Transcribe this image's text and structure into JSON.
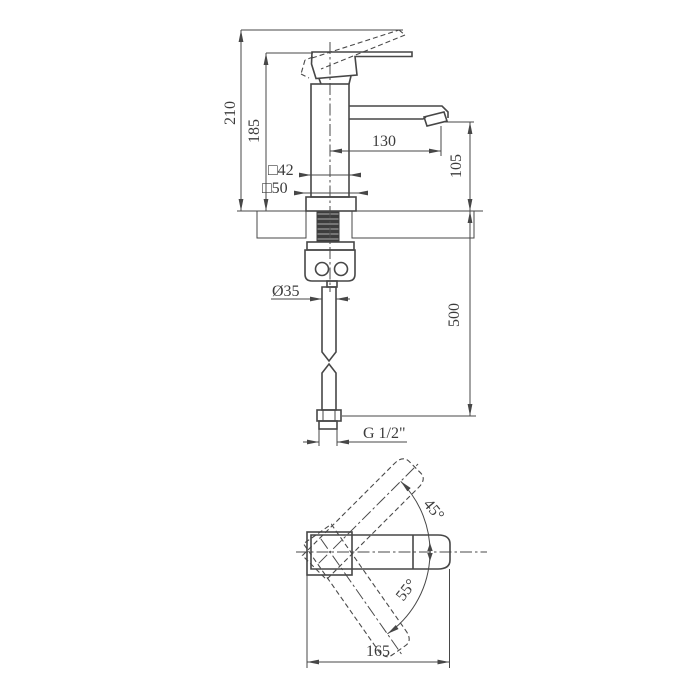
{
  "front_view": {
    "labels": {
      "height_total": "210",
      "height_lever": "185",
      "spout_reach": "130",
      "spout_height": "105",
      "body_section": "□42",
      "base_section": "□50",
      "shank_diameter": "Ø35",
      "hose_length": "500",
      "thread_size": "G 1/2\""
    }
  },
  "top_view": {
    "labels": {
      "swing_up": "45°",
      "swing_down": "55°",
      "overall_length": "165"
    }
  },
  "style": {
    "line_color": "#474747",
    "background": "#ffffff",
    "hatch_color": "#5a5a5a",
    "shank_fill": "#3d3d3d"
  }
}
